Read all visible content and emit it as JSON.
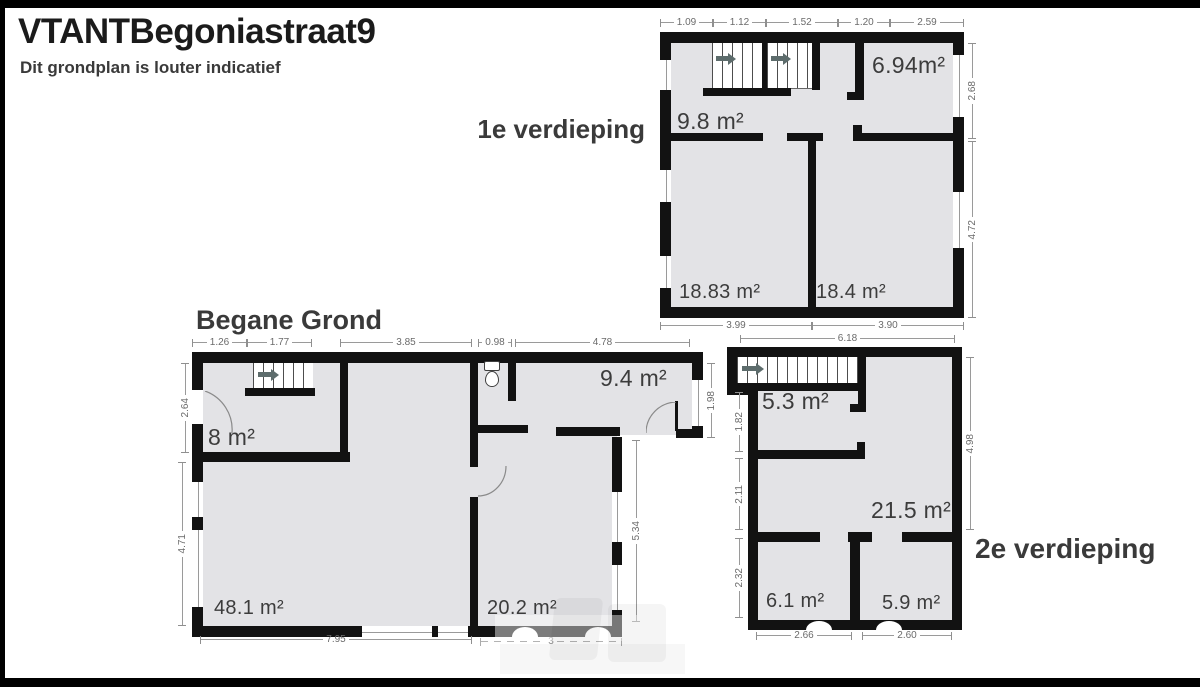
{
  "header": {
    "title": "VTANTBegoniastraat9",
    "subtitle": "Dit grondplan is louter indicatief"
  },
  "floors": {
    "first": {
      "label": "1e verdieping",
      "rooms": {
        "r1": "6.94m²",
        "r2": "9.8 m²",
        "r3": "18.83 m²",
        "r4": "18.4 m²"
      },
      "dims": {
        "top1": "1.09",
        "top2": "1.12",
        "top3": "1.52",
        "top4": "1.20",
        "top5": "2.59",
        "right1": "2.68",
        "right2": "4.72",
        "bottom1": "3.99",
        "bottom2": "3.90"
      }
    },
    "ground": {
      "label": "Begane Grond",
      "rooms": {
        "r1": "8 m²",
        "r2": "9.4 m²",
        "r3": "48.1 m²",
        "r4": "20.2 m²"
      },
      "dims": {
        "top1": "1.26",
        "top2": "1.77",
        "top3": "3.85",
        "top4": "0.98",
        "top5": "4.78",
        "left1": "2.64",
        "left2": "4.71",
        "right1": "1.98",
        "right2": "5.34",
        "bottom1": "7.95",
        "bottom2": "3"
      }
    },
    "second": {
      "label": "2e verdieping",
      "rooms": {
        "r1": "5.3 m²",
        "r2": "21.5 m²",
        "r3": "6.1 m²",
        "r4": "5.9 m²"
      },
      "dims": {
        "top1": "6.18",
        "left1": "1.82",
        "left2": "2.11",
        "left3": "2.32",
        "right1": "4.98",
        "bottom1": "2.66",
        "bottom2": "2.60"
      }
    }
  },
  "icons": {
    "stair_arrow": "right-arrow",
    "toilet": "toilet"
  },
  "colors": {
    "wall": "#121212",
    "floor": "#e3e3e6",
    "dim_text": "#6b6b6b",
    "stair_arrow": "#5d6c6c",
    "frame": "#000000"
  }
}
